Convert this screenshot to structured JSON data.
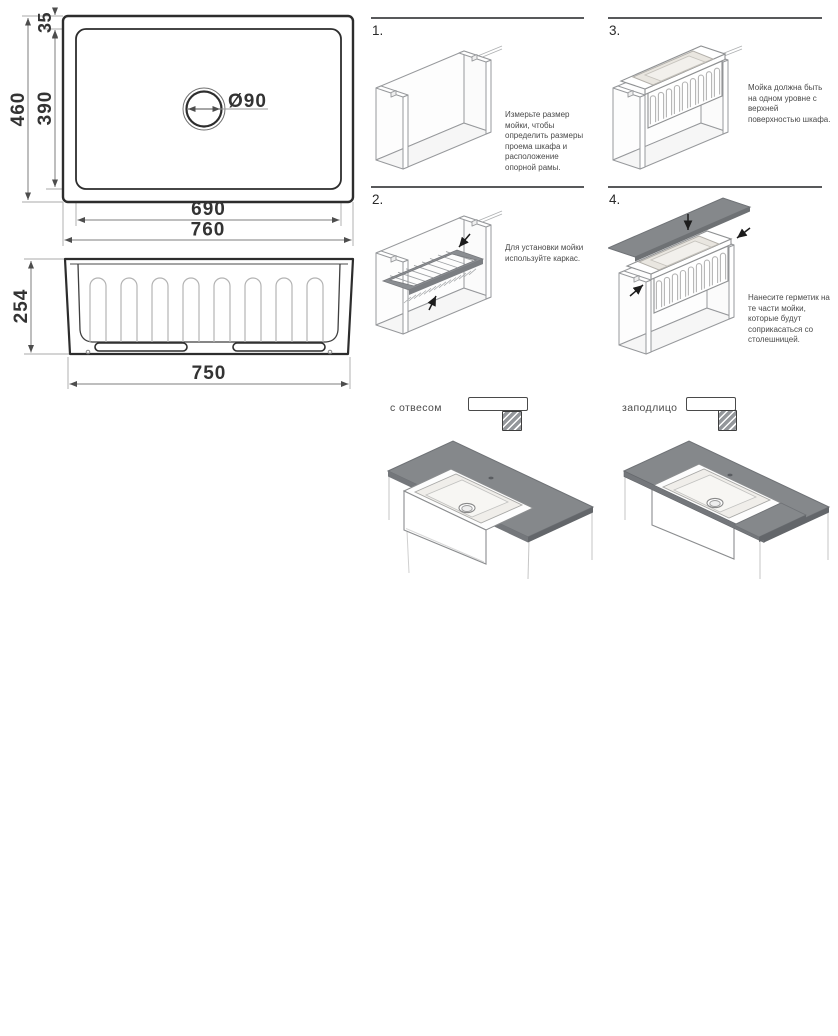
{
  "dimensions_top_view": {
    "overall_width": "760",
    "bowl_width": "690",
    "overall_depth": "460",
    "bowl_depth": "390",
    "rim_offset": "35",
    "drain_diameter": "Ø90"
  },
  "dimensions_front_view": {
    "height": "254",
    "base_width": "750"
  },
  "steps": [
    {
      "num": "1.",
      "text": "Измерьте размер мойки, чтобы определить размеры проема шкафа и расположение опорной рамы."
    },
    {
      "num": "2.",
      "text": "Для установки мойки используйте каркас."
    },
    {
      "num": "3.",
      "text": "Мойка должна быть на одном уровне с верхней поверхностью шкафа."
    },
    {
      "num": "4.",
      "text": "Нанесите герметик на те части мойки, которые будут соприкасаться со столешницей."
    }
  ],
  "mount_options": [
    {
      "label": "с отвесом"
    },
    {
      "label": "заподлицо"
    }
  ],
  "colors": {
    "countertop_gray": "#85888b",
    "frame_gray": "#8b8e92",
    "outline_dark": "#2d2d2d",
    "iso_line": "#97999c",
    "caption_text": "#4a4a4a"
  }
}
